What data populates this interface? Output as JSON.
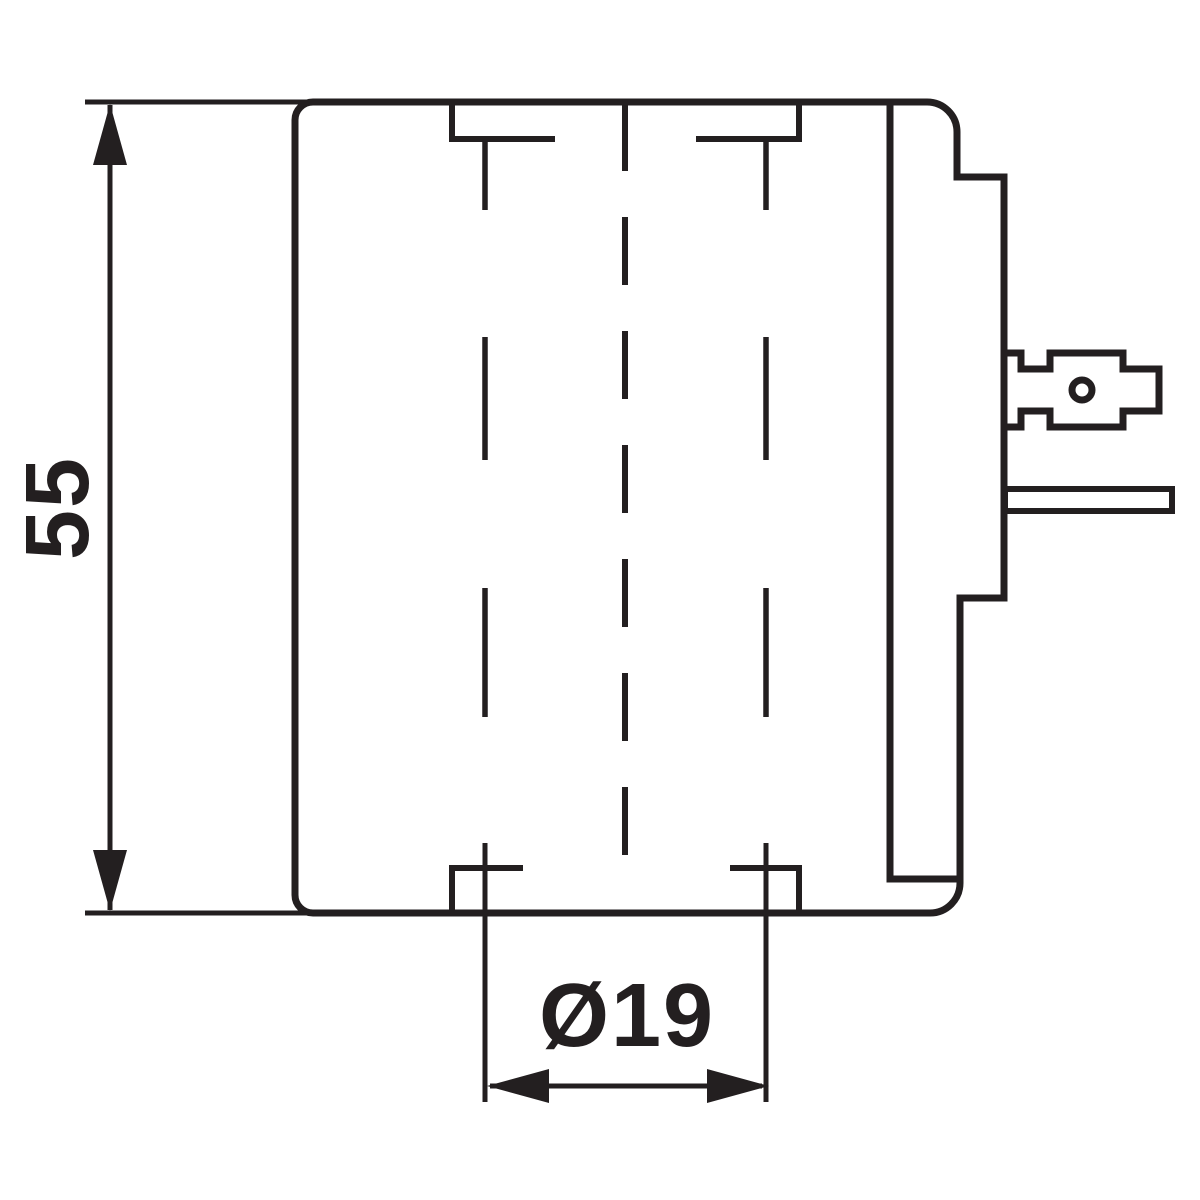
{
  "drawing": {
    "title": "solenoid-coil-side-view-dimension-drawing",
    "dimensions": {
      "height": {
        "label": "55"
      },
      "diameter": {
        "label": "Ø19"
      }
    },
    "colors": {
      "line": "#231f20",
      "background": "#ffffff"
    }
  }
}
